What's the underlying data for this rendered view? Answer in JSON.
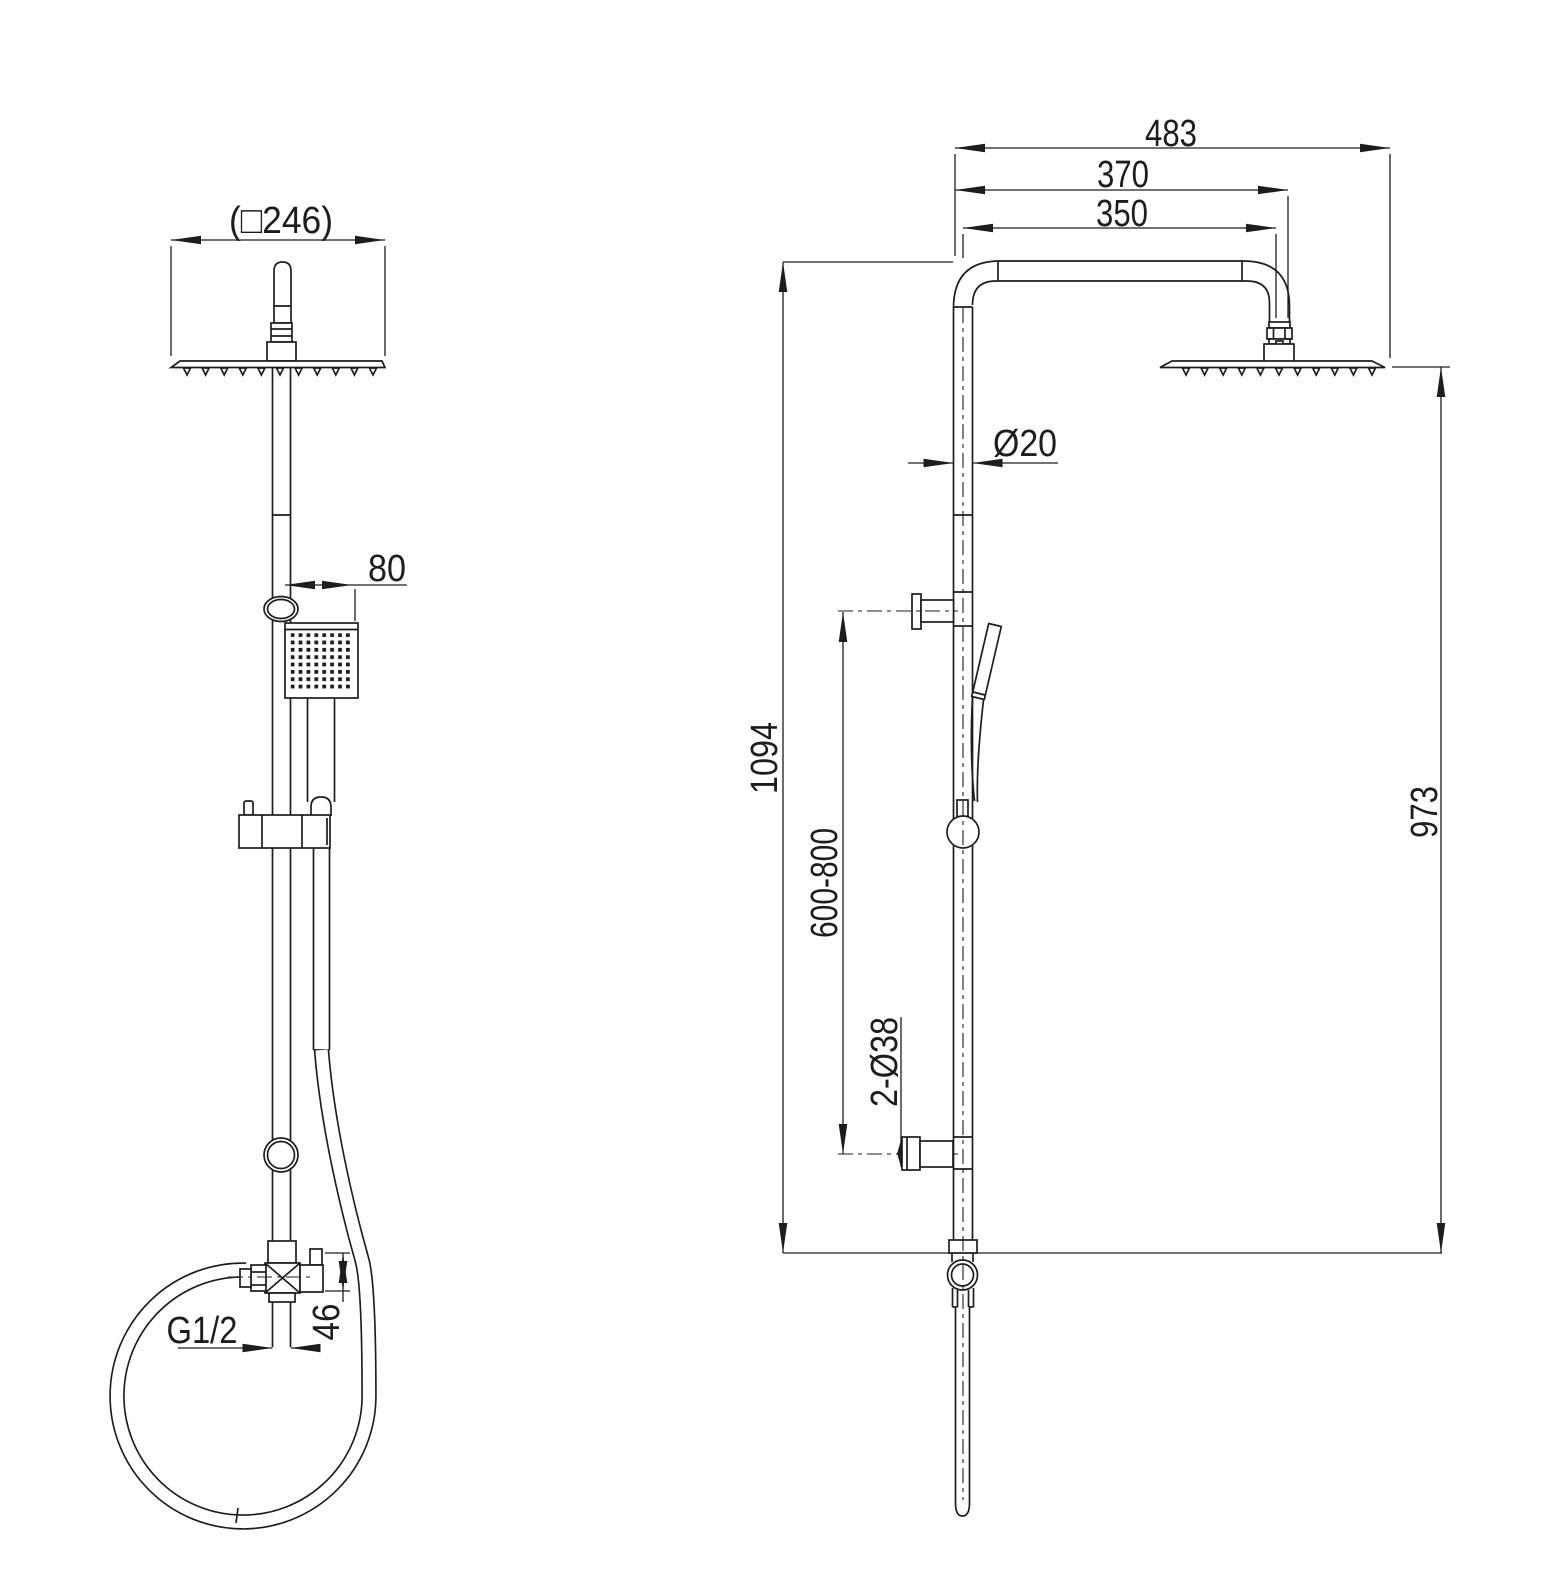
{
  "drawing": {
    "background": "#ffffff",
    "line_color": "#1d1d1d",
    "description": "Technical dimension drawing of a shower column with overhead rain shower and hand shower, front view and side view",
    "dimensions": {
      "front_view": {
        "head_width": "(□246)",
        "hand_shower_width": "80",
        "inlet_thread": "G1/2",
        "diverter_outlet_height": "46"
      },
      "side_view": {
        "arm_total_reach": "483",
        "arm_reach_to_joint": "370",
        "arm_length": "350",
        "pipe_diameter": "Ø20",
        "overall_height": "1094",
        "bracket_adjustable_range": "600-800",
        "column_height": "973",
        "wall_flange_diameter": "2-Ø38"
      }
    }
  }
}
